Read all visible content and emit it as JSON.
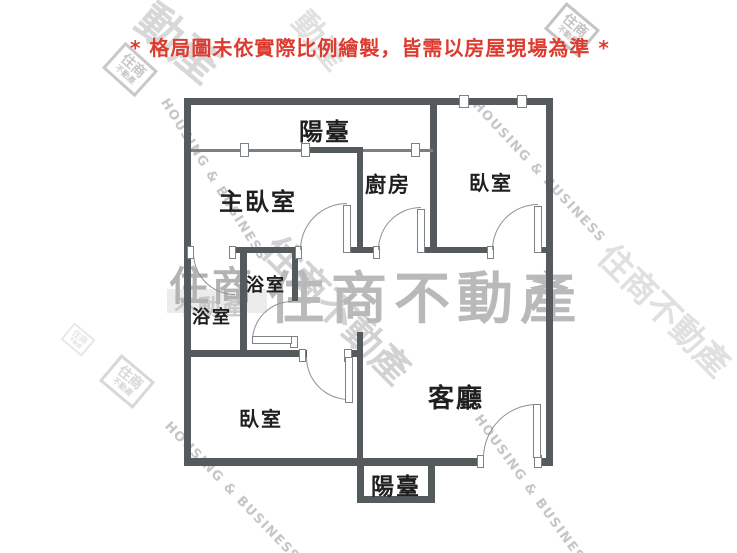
{
  "title": {
    "text": "* 格局圖未依實際比例繪製，皆需以房屋現場為準 *"
  },
  "colors": {
    "wall": "#555a5d",
    "title_red": "#dd3b2f",
    "watermark_gray": "#c6c6c6",
    "label_text": "#1f1f1f"
  },
  "floorplan": {
    "rooms": [
      {
        "id": "balcony-top",
        "label": "陽臺"
      },
      {
        "id": "master-bedroom",
        "label": "主臥室"
      },
      {
        "id": "kitchen",
        "label": "廚房"
      },
      {
        "id": "bedroom-top-right",
        "label": "臥室"
      },
      {
        "id": "bathroom-upper",
        "label": "浴室"
      },
      {
        "id": "bathroom-lower",
        "label": "浴室"
      },
      {
        "id": "bedroom-lower",
        "label": "臥室"
      },
      {
        "id": "living-room",
        "label": "客廳"
      },
      {
        "id": "balcony-bottom",
        "label": "陽臺"
      }
    ]
  },
  "watermark": {
    "brand": "住商不動產",
    "brand_main": "住商",
    "brand_sub": "不動產",
    "brand_en": "HOUSING & BUSINESS",
    "partial_cjk": "動產"
  }
}
